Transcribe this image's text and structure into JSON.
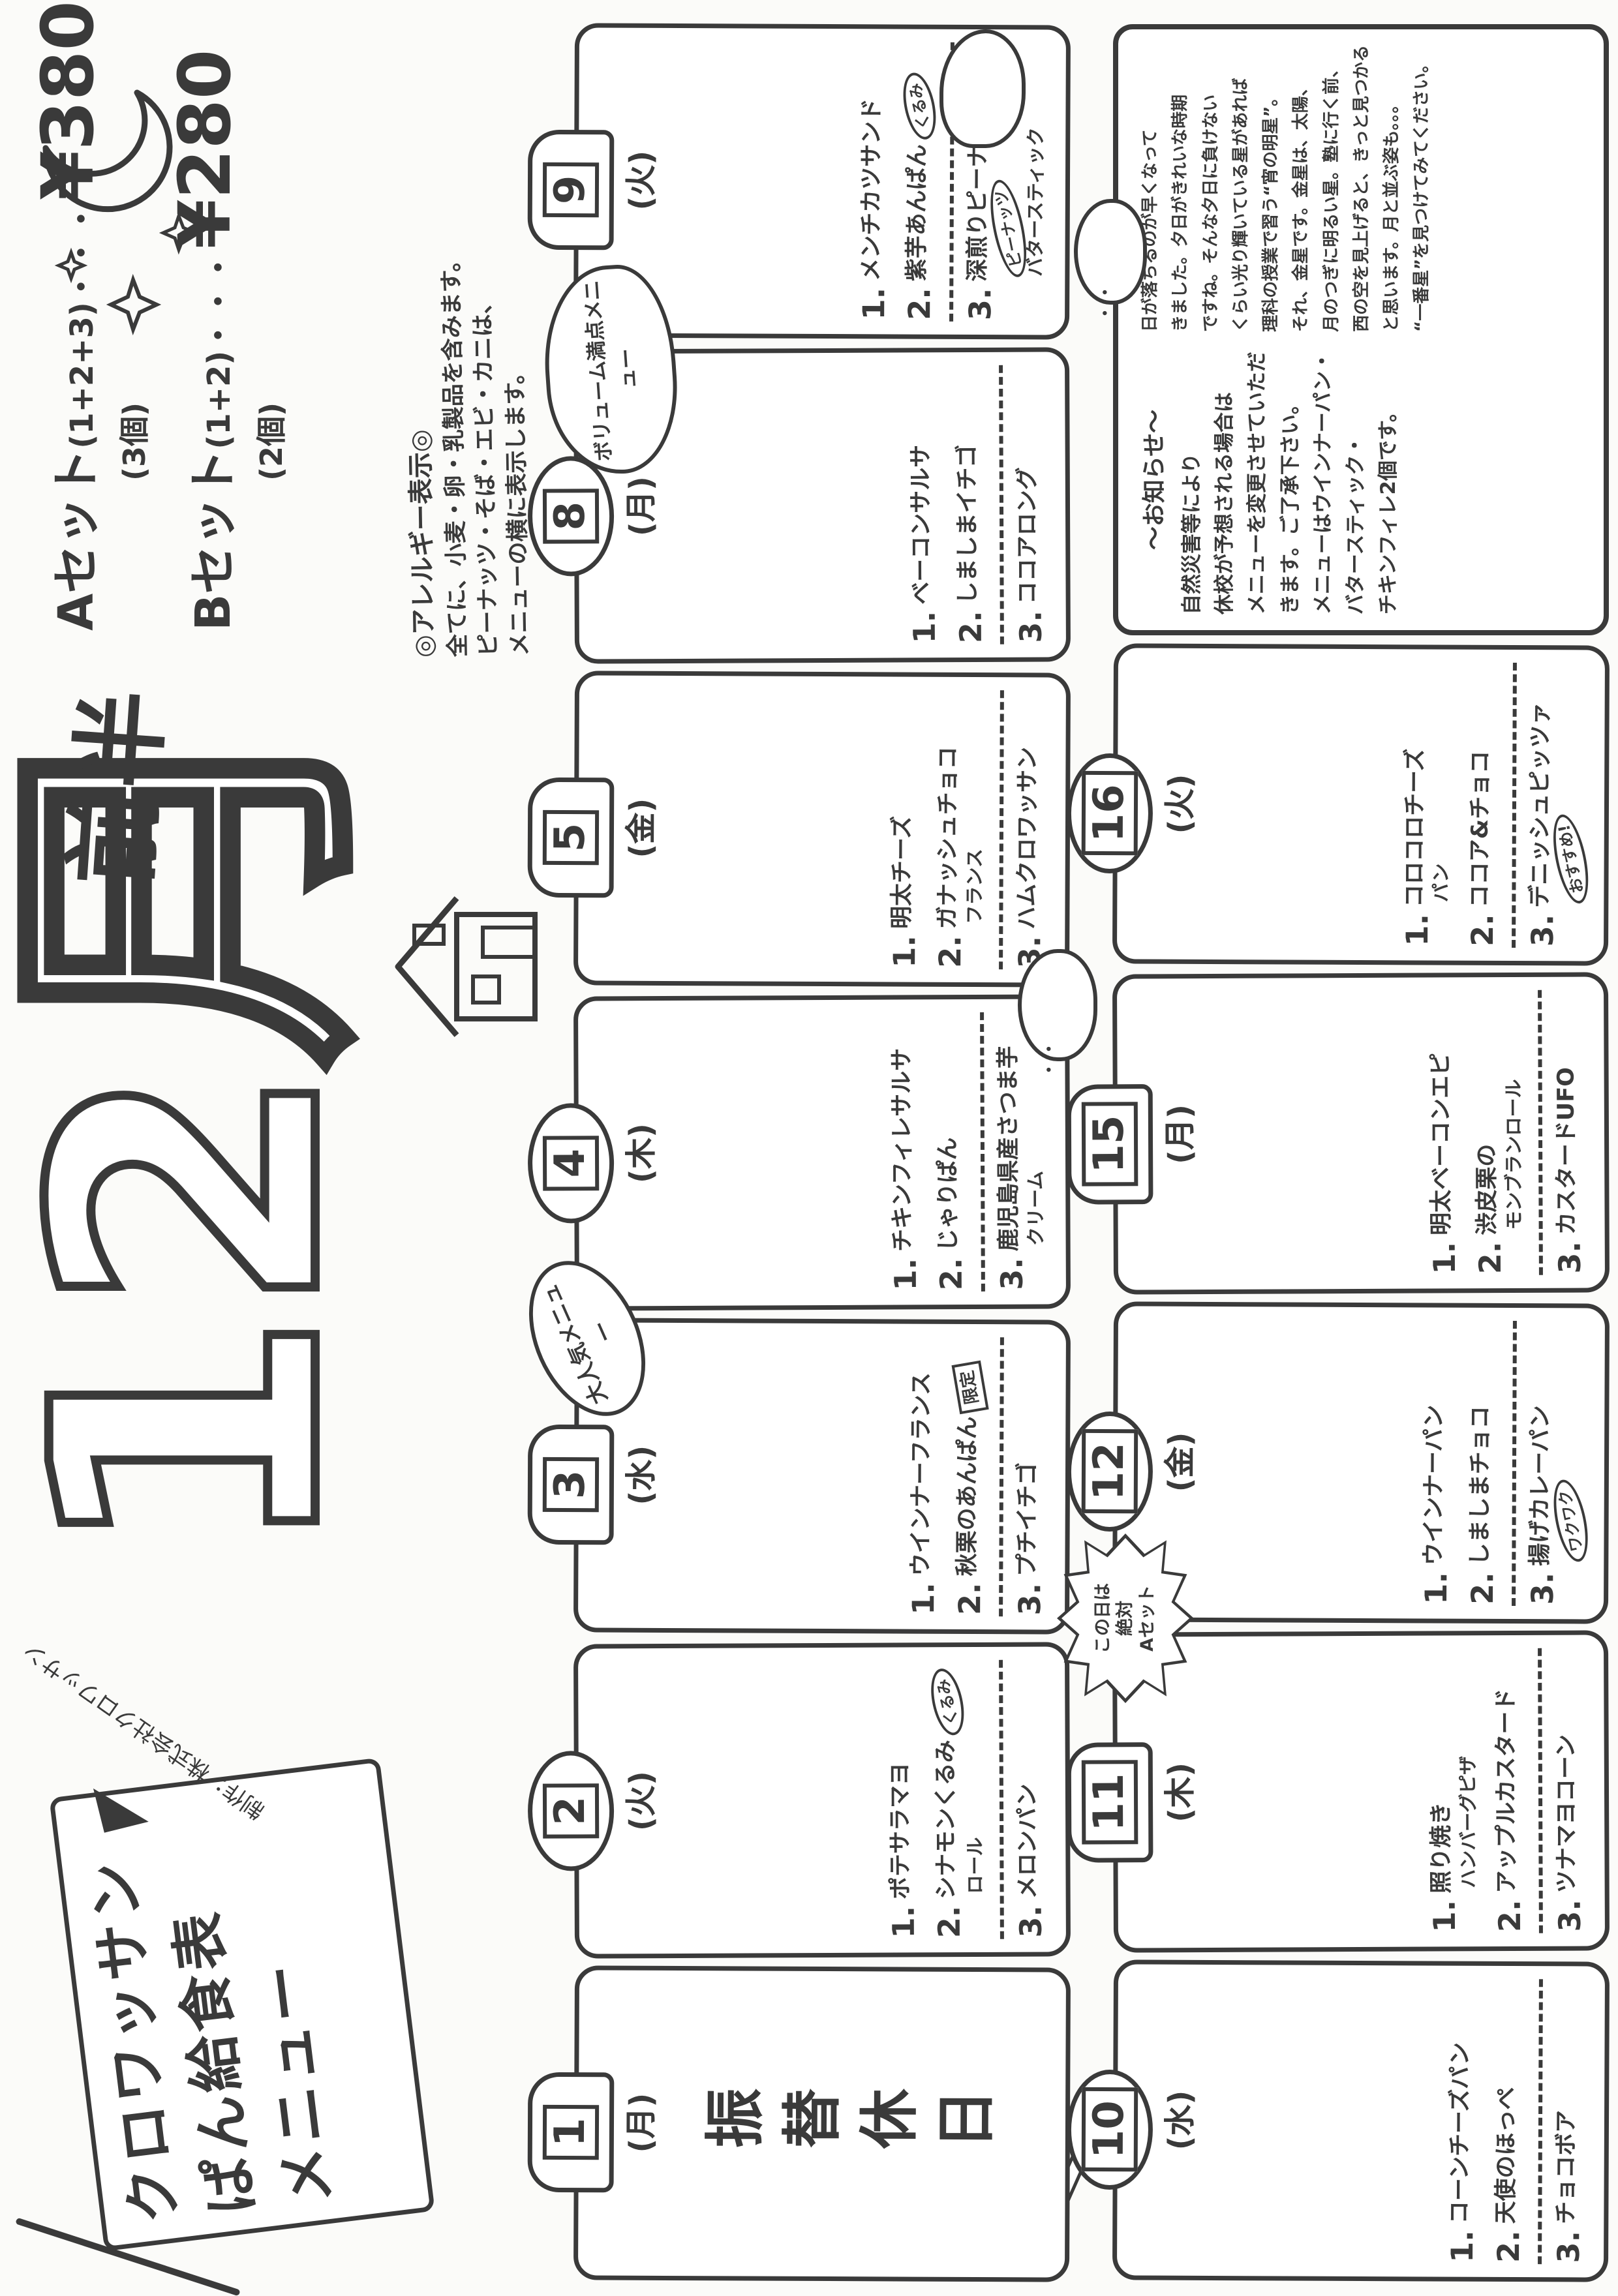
{
  "banner": {
    "line1": "クロワッサン",
    "line2": "ぱん給食表",
    "line3": "メニュー",
    "credit": "制作：株式会社クロワッサン"
  },
  "title": {
    "month": "12月",
    "half": "前半"
  },
  "prices": {
    "set_a": {
      "label": "Aセット",
      "formula": "(1+2+3)",
      "dots": "・・・",
      "price": "¥380",
      "qty": "(3個)"
    },
    "set_b": {
      "label": "Bセット",
      "formula": "(1+2)",
      "dots": "・・・",
      "price": "¥280",
      "qty": "(2個)"
    }
  },
  "allergy": {
    "header": "◎アレルギー表示◎",
    "lines": [
      "全てに、小麦・卵・乳製品を含みます。",
      "ピーナッツ・そば・エビ・カニは、",
      "メニューの横に表示します。"
    ]
  },
  "callouts": {
    "volume": "ボリューム満点メニュー",
    "popular": "大人気メニュー",
    "aset_lines": [
      "この日は",
      "絶対",
      "Aセット"
    ]
  },
  "days": [
    {
      "date": "1",
      "dow": "(月)",
      "row": 1,
      "holiday": "振替休日"
    },
    {
      "date": "2",
      "dow": "(火)",
      "row": 1,
      "items": [
        {
          "num": "1.",
          "text": "ポテサラマヨ"
        },
        {
          "num": "2.",
          "text": "シナモンくるみ",
          "badge": "くるみ",
          "sub": "ロール"
        },
        {
          "num": "3.",
          "text": "メロンパン"
        }
      ]
    },
    {
      "date": "3",
      "dow": "(水)",
      "row": 1,
      "items": [
        {
          "num": "1.",
          "text": "ウインナーフランス"
        },
        {
          "num": "2.",
          "text": "秋栗のあんぱん",
          "stamp": "限定"
        },
        {
          "num": "3.",
          "text": "プチイチゴ"
        }
      ]
    },
    {
      "date": "4",
      "dow": "(木)",
      "row": 1,
      "items": [
        {
          "num": "1.",
          "text": "チキンフィレサルサ"
        },
        {
          "num": "2.",
          "text": "じゃりぱん"
        },
        {
          "num": "3.",
          "text": "鹿児島県産さつま芋",
          "sub": "クリーム"
        }
      ]
    },
    {
      "date": "5",
      "dow": "(金)",
      "row": 1,
      "items": [
        {
          "num": "1.",
          "text": "明太チーズ"
        },
        {
          "num": "2.",
          "text": "ガナッシュチョコ",
          "sub": "フランス"
        },
        {
          "num": "3.",
          "text": "ハムクロワッサン"
        }
      ]
    },
    {
      "date": "8",
      "dow": "(月)",
      "row": 1,
      "items": [
        {
          "num": "1.",
          "text": "ベーコンサルサ"
        },
        {
          "num": "2.",
          "text": "しましまイチゴ"
        },
        {
          "num": "3.",
          "text": "ココアロング"
        }
      ]
    },
    {
      "date": "9",
      "dow": "(火)",
      "row": 1,
      "items": [
        {
          "num": "1.",
          "text": "メンチカツサンド"
        },
        {
          "num": "2.",
          "text": "紫芋あんぱん",
          "badge": "くるみ"
        },
        {
          "num": "3.",
          "text": "深煎りピーナッツ",
          "sub": "バタースティック",
          "badge": "ピーナッツ"
        }
      ]
    },
    {
      "date": "10",
      "dow": "(水)",
      "row": 2,
      "items": [
        {
          "num": "1.",
          "text": "コーンチーズパン"
        },
        {
          "num": "2.",
          "text": "天使のほっぺ"
        },
        {
          "num": "3.",
          "text": "チョコボア"
        }
      ]
    },
    {
      "date": "11",
      "dow": "(木)",
      "row": 2,
      "items": [
        {
          "num": "1.",
          "text": "照り焼き",
          "sub": "ハンバーグピザ"
        },
        {
          "num": "2.",
          "text": "アップルカスタード"
        },
        {
          "num": "3.",
          "text": "ツナマヨコーン"
        }
      ]
    },
    {
      "date": "12",
      "dow": "(金)",
      "row": 2,
      "items": [
        {
          "num": "1.",
          "text": "ウインナーパン"
        },
        {
          "num": "2.",
          "text": "しましまチョコ"
        },
        {
          "num": "3.",
          "text": "揚げカレーパン",
          "badge": "ワクワク"
        }
      ]
    },
    {
      "date": "15",
      "dow": "(月)",
      "row": 2,
      "items": [
        {
          "num": "1.",
          "text": "明太ベーコンエピ"
        },
        {
          "num": "2.",
          "text": "渋皮栗の",
          "sub": "モンブランロール"
        },
        {
          "num": "3.",
          "text": "カスタードUFO"
        }
      ]
    },
    {
      "date": "16",
      "dow": "(火)",
      "row": 2,
      "items": [
        {
          "num": "1.",
          "text": "コロコロチーズ",
          "sub": "パン"
        },
        {
          "num": "2.",
          "text": "ココア&チョコ"
        },
        {
          "num": "3.",
          "text": "デニッシュピッツァ",
          "badge": "おすすめ!"
        }
      ]
    }
  ],
  "notice": {
    "header": "〜お知らせ〜",
    "lines": [
      "自然災害等により",
      "休校が予想される場合は",
      "メニューを変更させていただ",
      "きます。ご了承下さい。",
      "メニューはウインナーパン・",
      "バタースティック・",
      "チキンフィレ2個です。"
    ]
  },
  "essay": {
    "lines": [
      "日が落ちるのが早くなって",
      "きました。夕日がきれいな時期",
      "ですね。そんな夕日に負けない",
      "くらい光り輝いている星があれば",
      "理科の授業で習う“宵の明星”。",
      "それ、金星です。金星は、太陽、",
      "月のつぎに明るい星。塾に行く前、",
      "西の空を見上げると、きっと見つかる",
      "と思います。月と並ぶ姿も。。。",
      "“一番星”を見つけてみてください。"
    ]
  }
}
